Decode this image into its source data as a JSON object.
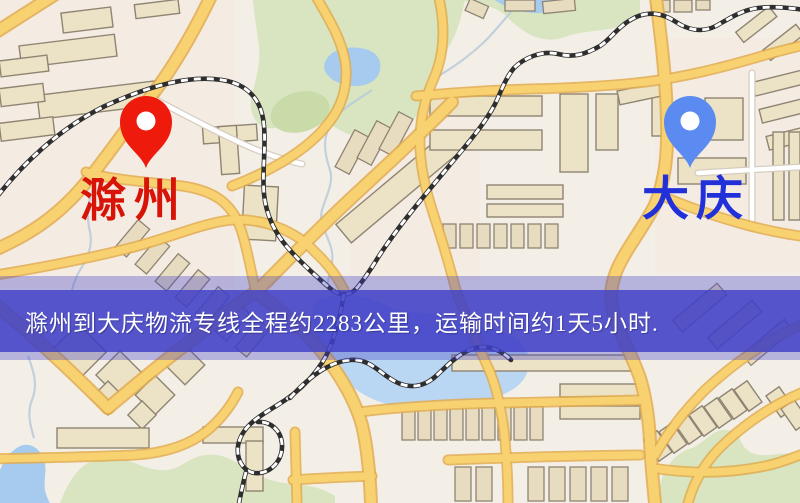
{
  "map": {
    "type": "logistics-route-map",
    "markers": [
      {
        "name": "滁州",
        "pin": "red-pin-icon",
        "color": "#ee1a0c",
        "label_color": "#d81408",
        "position": "left"
      },
      {
        "name": "大庆",
        "pin": "blue-pin-icon",
        "color": "#5b8bf0",
        "label_color": "#2130d8",
        "position": "right"
      }
    ],
    "banner": {
      "text": "滁州到大庆物流专线全程约2283公里，运输时间约1天5小时.",
      "bg": "#4040c6",
      "fg": "#ffffff",
      "distance_km": "2283",
      "duration": "1天5小时"
    },
    "palette": {
      "background": "#f3efe7",
      "tint": "#f7e9de",
      "road_major": "#f8d271",
      "road_casing": "#e2ab4e",
      "road_minor": "#ffffff",
      "road_minor_casing": "#d5cdbf",
      "water": "#a6cbef",
      "water_light": "#b9d6f2",
      "park": "#d8e5c0",
      "park_dark": "#c9dba9",
      "building": "#ece2c6",
      "building_alt": "#e8dcc0",
      "building_outline": "#8f8472",
      "railway_dark": "#2e2e2e",
      "railway_light": "#ffffff",
      "stream": "#b9cad9"
    }
  }
}
